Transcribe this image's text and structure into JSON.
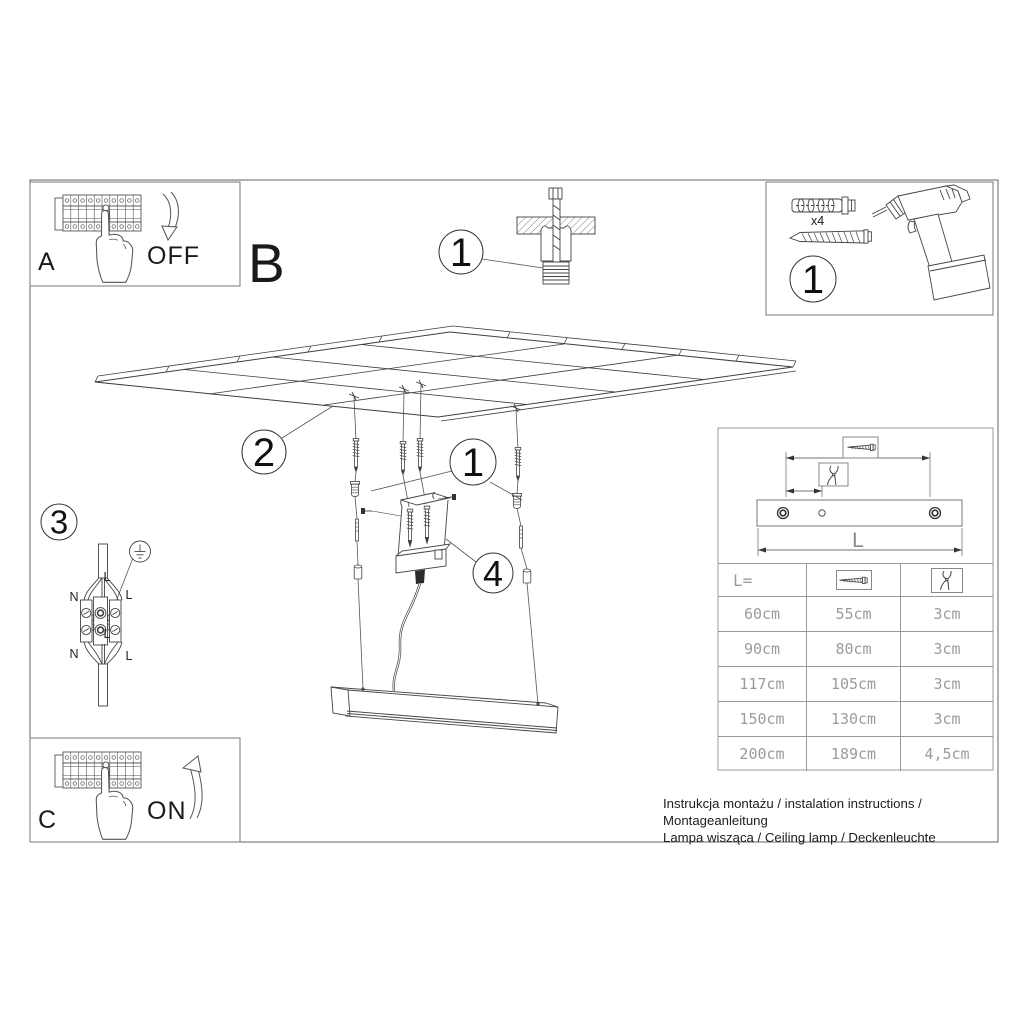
{
  "steps": {
    "a_label": "A",
    "b_label": "B",
    "c_label": "C",
    "off": "OFF",
    "on": "ON"
  },
  "callouts": {
    "anchor_detail": "1",
    "tools": "1",
    "ceiling": "2",
    "wiring": "3",
    "hardware": "1",
    "canopy": "4"
  },
  "tools": {
    "plug_qty": "x4"
  },
  "wiring": {
    "cable_top": "L",
    "left_top": "N",
    "right_top": "L",
    "middle": "L",
    "left_bottom": "N",
    "right_bottom": "L"
  },
  "diagram": {
    "length_label": "L"
  },
  "size_table": {
    "length_header": "L=",
    "rows": [
      [
        "60cm",
        "55cm",
        "3cm"
      ],
      [
        "90cm",
        "80cm",
        "3cm"
      ],
      [
        "117cm",
        "105cm",
        "3cm"
      ],
      [
        "150cm",
        "130cm",
        "3cm"
      ],
      [
        "200cm",
        "189cm",
        "4,5cm"
      ]
    ]
  },
  "footer": {
    "line1": "Instrukcja montażu / instalation instructions / Montageanleitung",
    "line2": "Lampa wisząca / Ceiling lamp / Deckenleuchte"
  },
  "icons": {
    "screw": "screw-icon",
    "pliers": "cutting-pliers-icon",
    "wall_plug": "wall-plug-icon",
    "drill": "drill-icon",
    "ground": "earth-ground-icon",
    "breaker": "breaker-panel-icon",
    "hand": "pointing-hand-icon",
    "arrow_down": "arrow-down-icon",
    "arrow_up": "arrow-up-icon"
  }
}
